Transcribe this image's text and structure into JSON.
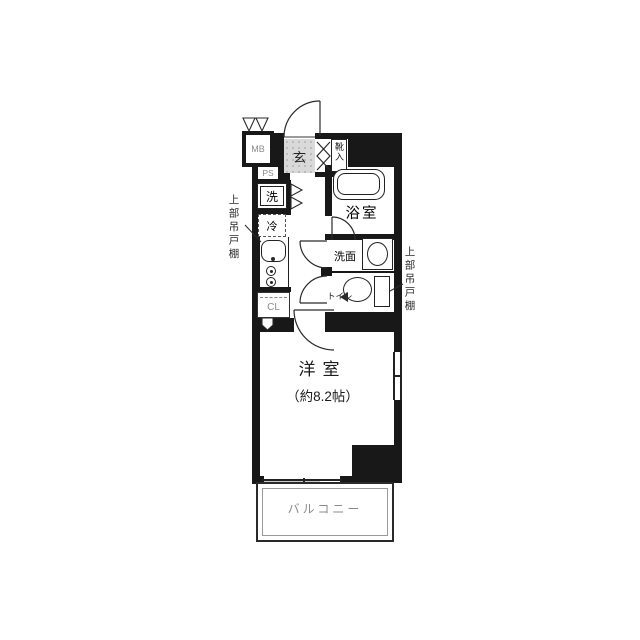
{
  "floorplan": {
    "labels": {
      "meter_box": "MB",
      "pipe_space": "PS",
      "entrance": "玄",
      "shoe_storage": "靴入",
      "washer": "洗",
      "fridge": "冷",
      "closet": "CL",
      "bathroom": "浴室",
      "washroom": "洗面",
      "toilet": "トイレ",
      "main_room": "洋室",
      "main_room_size": "（約8.2帖）",
      "balcony": "バルコニー",
      "upper_cupboard_left": "上部吊戸棚",
      "upper_cupboard_right": "上部吊戸棚"
    },
    "colors": {
      "wall": "#181818",
      "line": "#2a2a2a",
      "muted_text": "#8b8b8b",
      "entrance_floor": "#d9d9d9",
      "background": "#ffffff"
    }
  }
}
